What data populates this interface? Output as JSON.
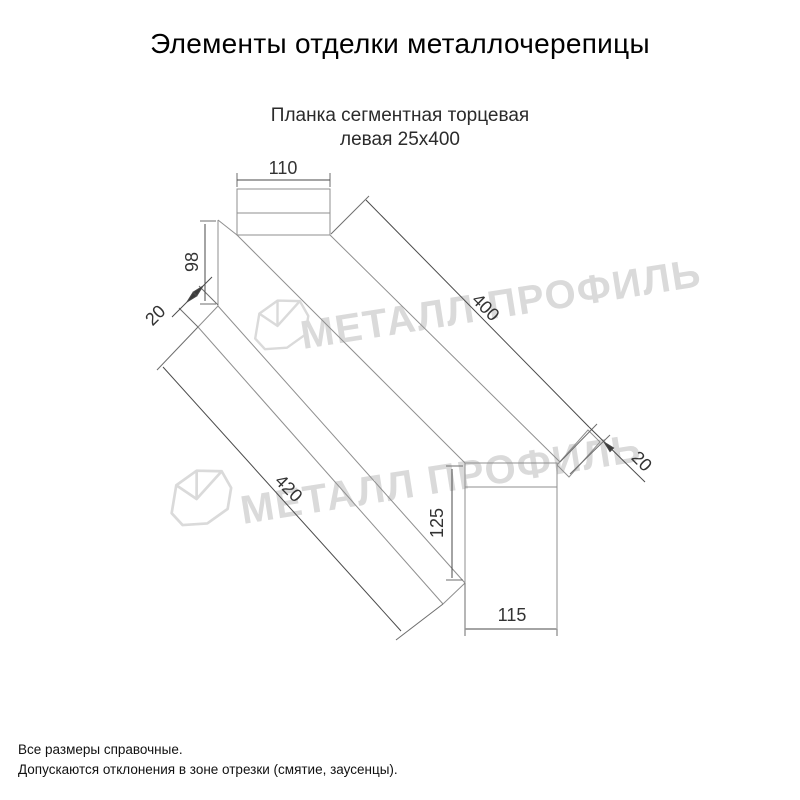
{
  "header": {
    "title": "Элементы отделки металлочерепицы"
  },
  "drawing": {
    "subtitle_line1": "Планка сегментная торцевая",
    "subtitle_line2": "левая 25х400",
    "dims": {
      "flange_width": "110",
      "left_height": "98",
      "left_hem": "20",
      "top_length": "400",
      "bottom_length": "420",
      "right_height": "125",
      "bottom_width": "115",
      "right_hem": "20"
    }
  },
  "watermark": {
    "text": "МЕТАЛЛ ПРОФИЛЬ",
    "color": "#dadada"
  },
  "footer": {
    "line1": "Все размеры справочные.",
    "line2": "Допускаются отклонения в зоне отрезки (смятие, заусенцы)."
  }
}
